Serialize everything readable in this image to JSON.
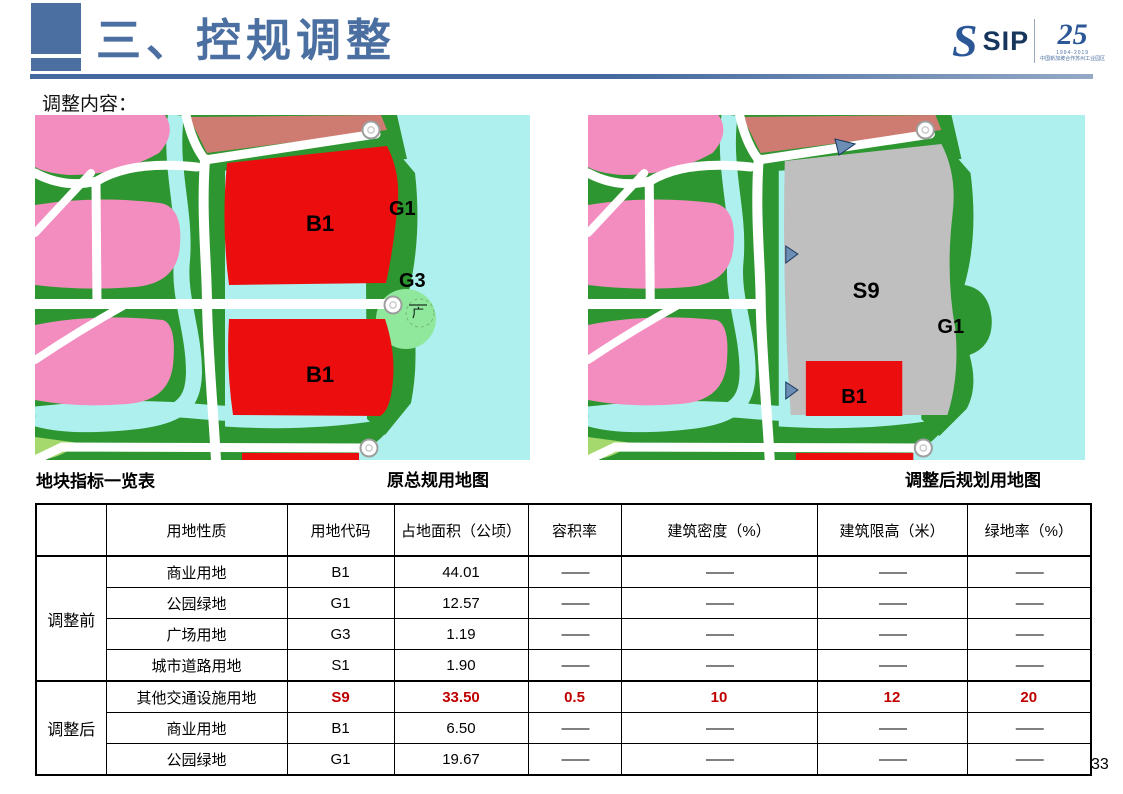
{
  "header": {
    "title": "三、控规调整"
  },
  "logo": {
    "s": "S",
    "sip": "SIP",
    "anniversary": "25",
    "years": "1994-2019",
    "caption": "中国新加坡合作苏州工业园区"
  },
  "intro": "调整内容：",
  "maps": {
    "before": {
      "caption": "原总规用地图",
      "labels": {
        "b1_top": "B1",
        "g1": "G1",
        "g3": "G3",
        "plaza": "广",
        "b1_bottom": "B1"
      }
    },
    "after": {
      "caption": "调整后规划用地图",
      "labels": {
        "s9": "S9",
        "g1": "G1",
        "b1": "B1"
      }
    }
  },
  "table_title": "地块指标一览表",
  "table": {
    "headers": [
      "",
      "用地性质",
      "用地代码",
      "占地面积（公顷）",
      "容积率",
      "建筑密度（%）",
      "建筑限高（米）",
      "绿地率（%）"
    ],
    "group_before": {
      "label": "调整前",
      "rows": [
        [
          "商业用地",
          "B1",
          "44.01",
          "——",
          "——",
          "——",
          "——"
        ],
        [
          "公园绿地",
          "G1",
          "12.57",
          "——",
          "——",
          "——",
          "——"
        ],
        [
          "广场用地",
          "G3",
          "1.19",
          "——",
          "——",
          "——",
          "——"
        ],
        [
          "城市道路用地",
          "S1",
          "1.90",
          "——",
          "——",
          "——",
          "——"
        ]
      ]
    },
    "group_after": {
      "label": "调整后",
      "rows": [
        [
          "其他交通设施用地",
          "S9",
          "33.50",
          "0.5",
          "10",
          "12",
          "20"
        ],
        [
          "商业用地",
          "B1",
          "6.50",
          "——",
          "——",
          "——",
          "——"
        ],
        [
          "公园绿地",
          "G1",
          "19.67",
          "——",
          "——",
          "——",
          "——"
        ]
      ]
    }
  },
  "page_number": "33",
  "colors": {
    "accent": "#4a6fa0",
    "highlight": "#c00000",
    "water": "#aef0ee",
    "green": "#2e9630",
    "pink": "#f38cbf",
    "red": "#ec0e0e",
    "gray": "#bfbfbf",
    "dark_red": "#ce7b72",
    "plaza_green": "#8fe89b"
  }
}
